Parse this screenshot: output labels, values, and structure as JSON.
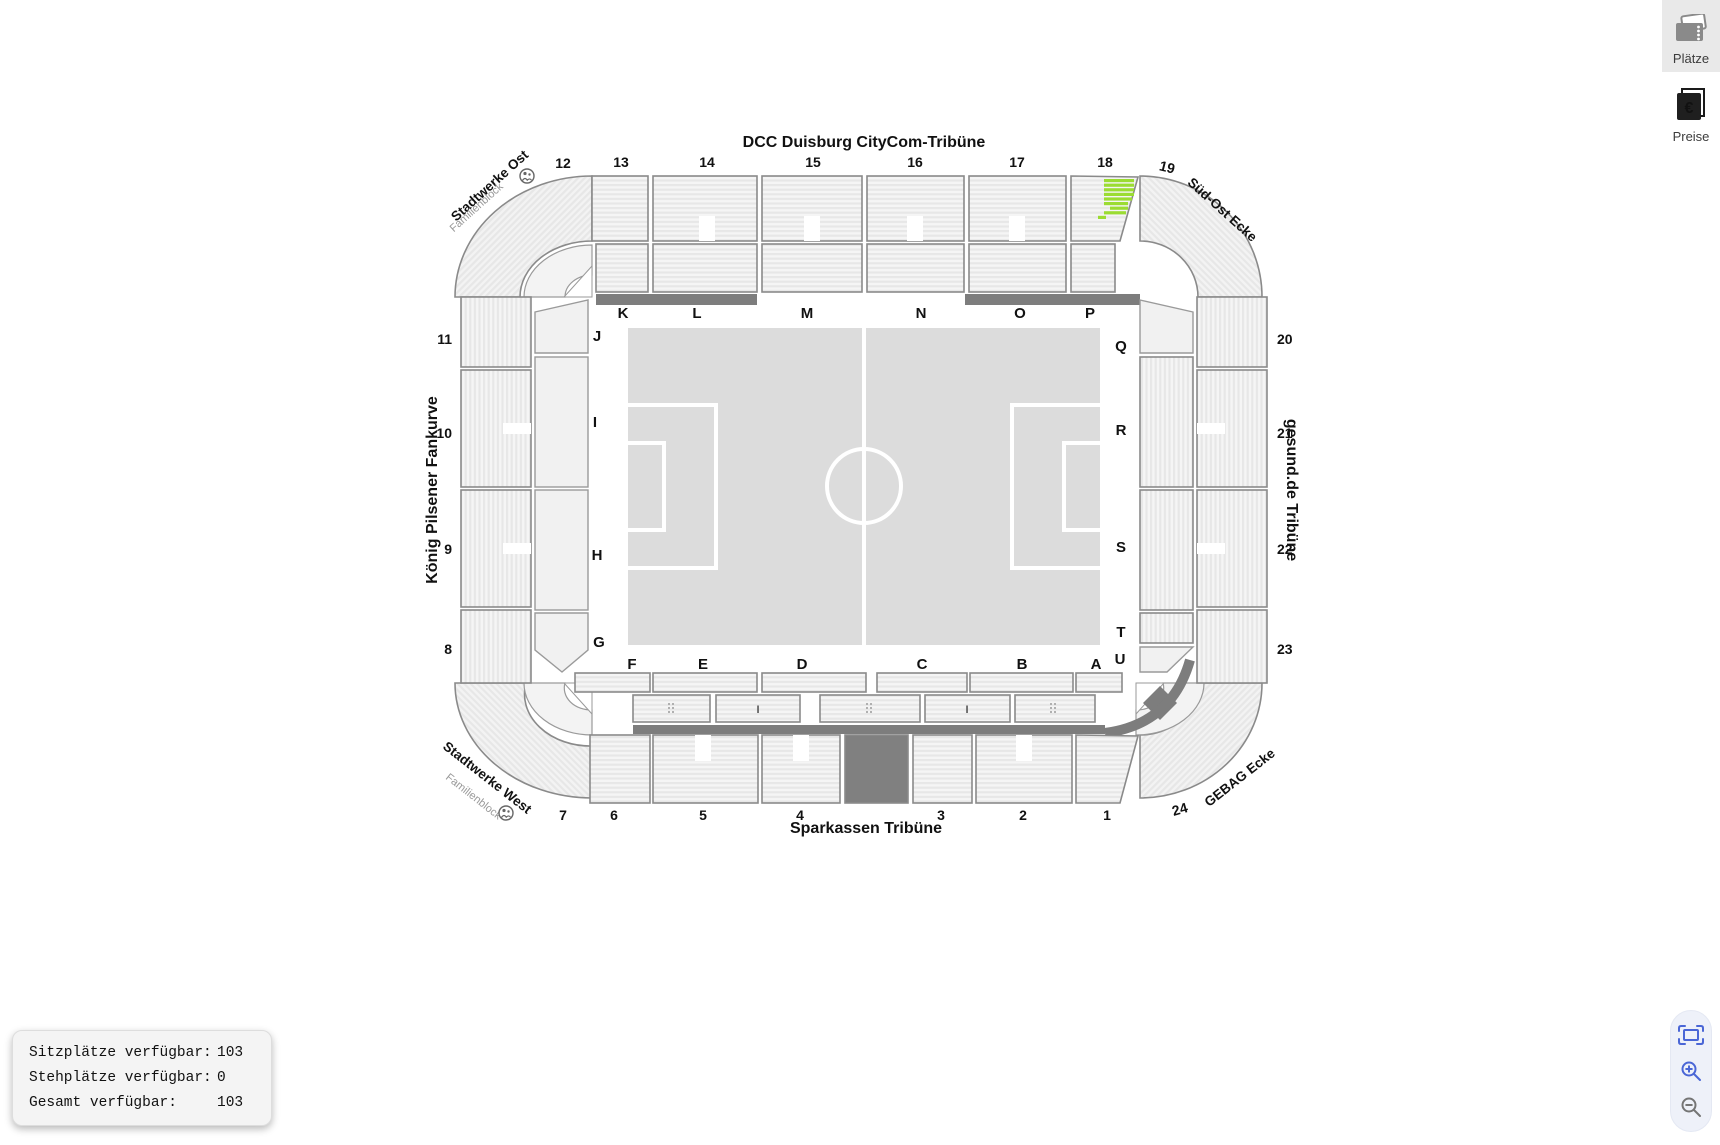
{
  "stadium": {
    "title_north": "DCC Duisburg CityCom-Tribüne",
    "title_south": "Sparkassen Tribüne",
    "title_west": "König Pilsener Fankurve",
    "title_east": "gesund.de Tribüne",
    "corner_nw": {
      "label": "Stadtwerke Ost",
      "sub": "Familienblock"
    },
    "corner_ne": {
      "label": "Süd-Ost Ecke"
    },
    "corner_sw": {
      "label": "Stadtwerke West",
      "sub": "Familienblock"
    },
    "corner_se": {
      "label": "GEBAG Ecke"
    },
    "top_numbers": [
      "12",
      "13",
      "14",
      "15",
      "16",
      "17",
      "18",
      "19"
    ],
    "left_numbers": [
      "11",
      "10",
      "9",
      "8"
    ],
    "right_numbers": [
      "20",
      "21",
      "22",
      "23"
    ],
    "bottom_numbers": [
      "7",
      "6",
      "5",
      "4",
      "3",
      "2",
      "1",
      "24"
    ],
    "letters_top": [
      "K",
      "L",
      "M",
      "N",
      "O",
      "P"
    ],
    "letters_right": [
      "Q",
      "R",
      "S",
      "T",
      "U"
    ],
    "letters_bottom": [
      "F",
      "E",
      "D",
      "C",
      "B",
      "A"
    ],
    "letters_left": [
      "J",
      "I",
      "H",
      "G"
    ],
    "lower_tier_marks": [
      "I",
      "I"
    ],
    "highlight": {
      "block": "18",
      "color": "#9BDC32"
    }
  },
  "toolbar": {
    "plaetze_label": "Plätze",
    "preise_label": "Preise",
    "preise_currency": "€"
  },
  "availability": {
    "rows": [
      {
        "label": "Sitzplätze verfügbar:",
        "value": "103"
      },
      {
        "label": "Stehplätze verfügbar:",
        "value": "0"
      },
      {
        "label": "Gesamt verfügbar:",
        "value": "103"
      }
    ]
  },
  "colors": {
    "highlight_green": "#9BDC32",
    "walkway_dark": "#7d7d7d",
    "closed_block": "#808080",
    "accent_blue": "#4a66d6"
  }
}
